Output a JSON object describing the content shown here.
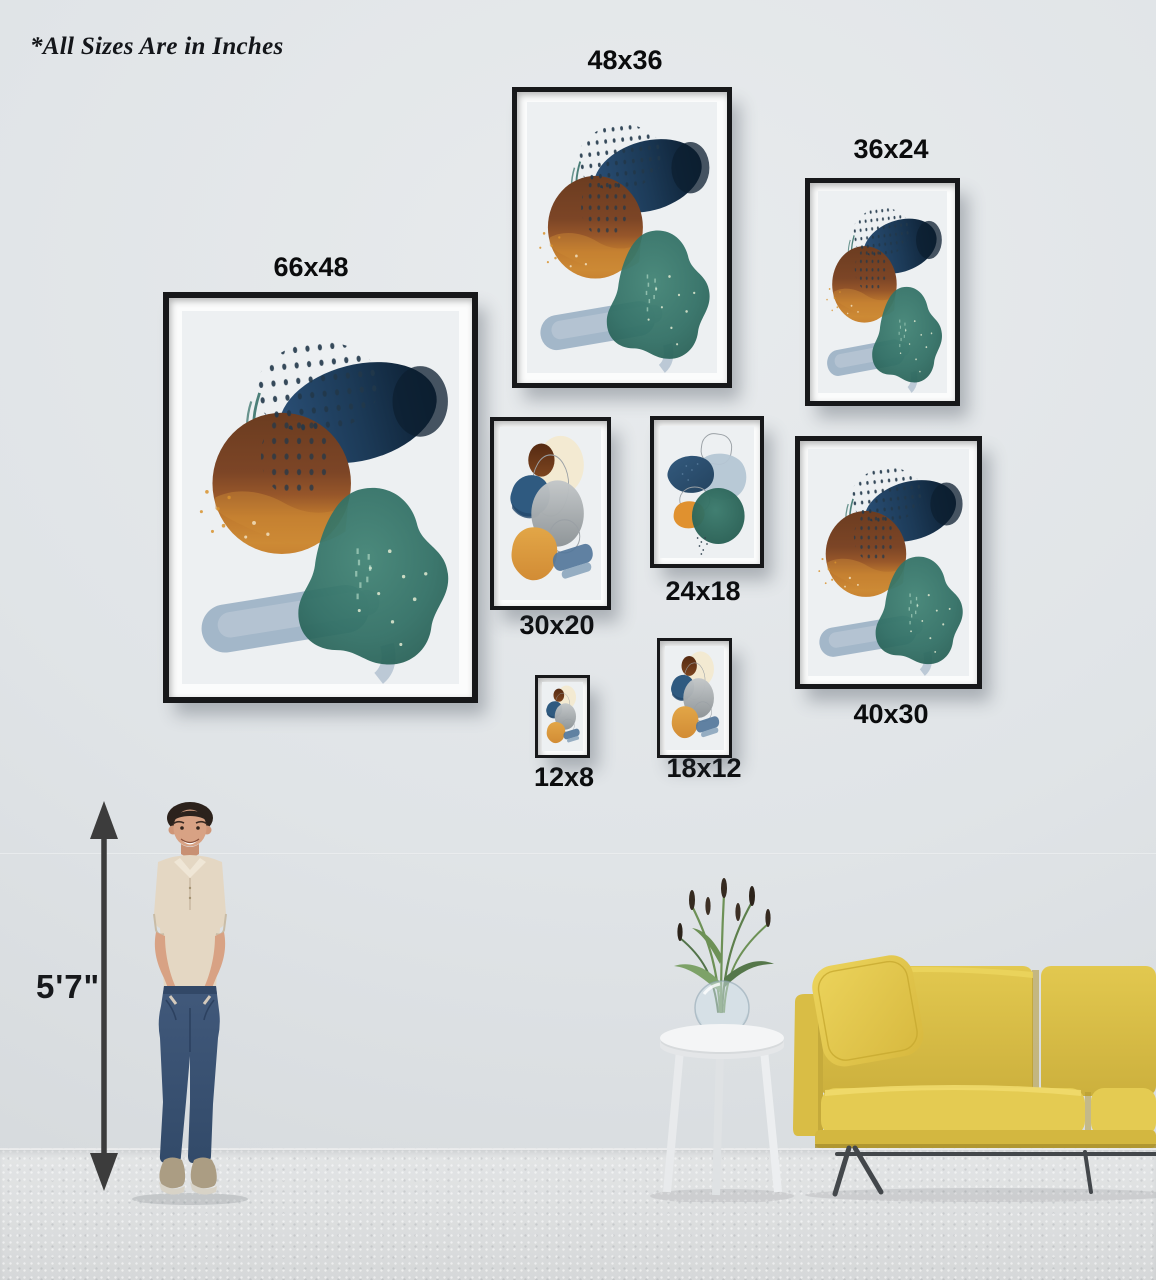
{
  "units_note": "*All Sizes Are in Inches",
  "height_reference": {
    "label": "5'7\"",
    "figure": "standing-man"
  },
  "frames": [
    {
      "size": "66x48",
      "label": "66x48",
      "orientation": "portrait",
      "label_position": "above",
      "artwork": "abstract-watercolor-teal-navy-amber"
    },
    {
      "size": "48x36",
      "label": "48x36",
      "orientation": "portrait",
      "label_position": "above",
      "artwork": "abstract-watercolor-teal-navy-amber"
    },
    {
      "size": "36x24",
      "label": "36x24",
      "orientation": "portrait",
      "label_position": "above",
      "artwork": "abstract-watercolor-teal-navy-amber"
    },
    {
      "size": "30x20",
      "label": "30x20",
      "orientation": "portrait",
      "label_position": "below",
      "artwork": "abstract-watercolor-orange-gray-stack"
    },
    {
      "size": "24x18",
      "label": "24x18",
      "orientation": "portrait",
      "label_position": "below",
      "artwork": "abstract-watercolor-blue-teal-trio"
    },
    {
      "size": "40x30",
      "label": "40x30",
      "orientation": "portrait",
      "label_position": "below",
      "artwork": "abstract-watercolor-teal-navy-amber"
    },
    {
      "size": "12x8",
      "label": "12x8",
      "orientation": "portrait",
      "label_position": "below",
      "artwork": "abstract-watercolor-orange-gray-stack"
    },
    {
      "size": "18x12",
      "label": "18x12",
      "orientation": "portrait",
      "label_position": "below",
      "artwork": "abstract-watercolor-orange-gray-stack"
    }
  ],
  "scene": {
    "wall_color": "#e0e4e7",
    "floor_color": "#dadcdd",
    "frame_color": "#17181a",
    "sofa_color": "#dcc24a",
    "furniture": [
      "standing-man",
      "round-side-table",
      "glass-vase-with-dried-plant",
      "yellow-sofa"
    ]
  },
  "art_palette": {
    "navy": "#1c3a57",
    "brown": "#7c4526",
    "amber": "#c8802f",
    "teal": "#2f7065",
    "blue_gray": "#93aabf",
    "cream": "#f3ead2",
    "gray": "#9ba1a5",
    "steel_blue": "#2f5a80"
  }
}
